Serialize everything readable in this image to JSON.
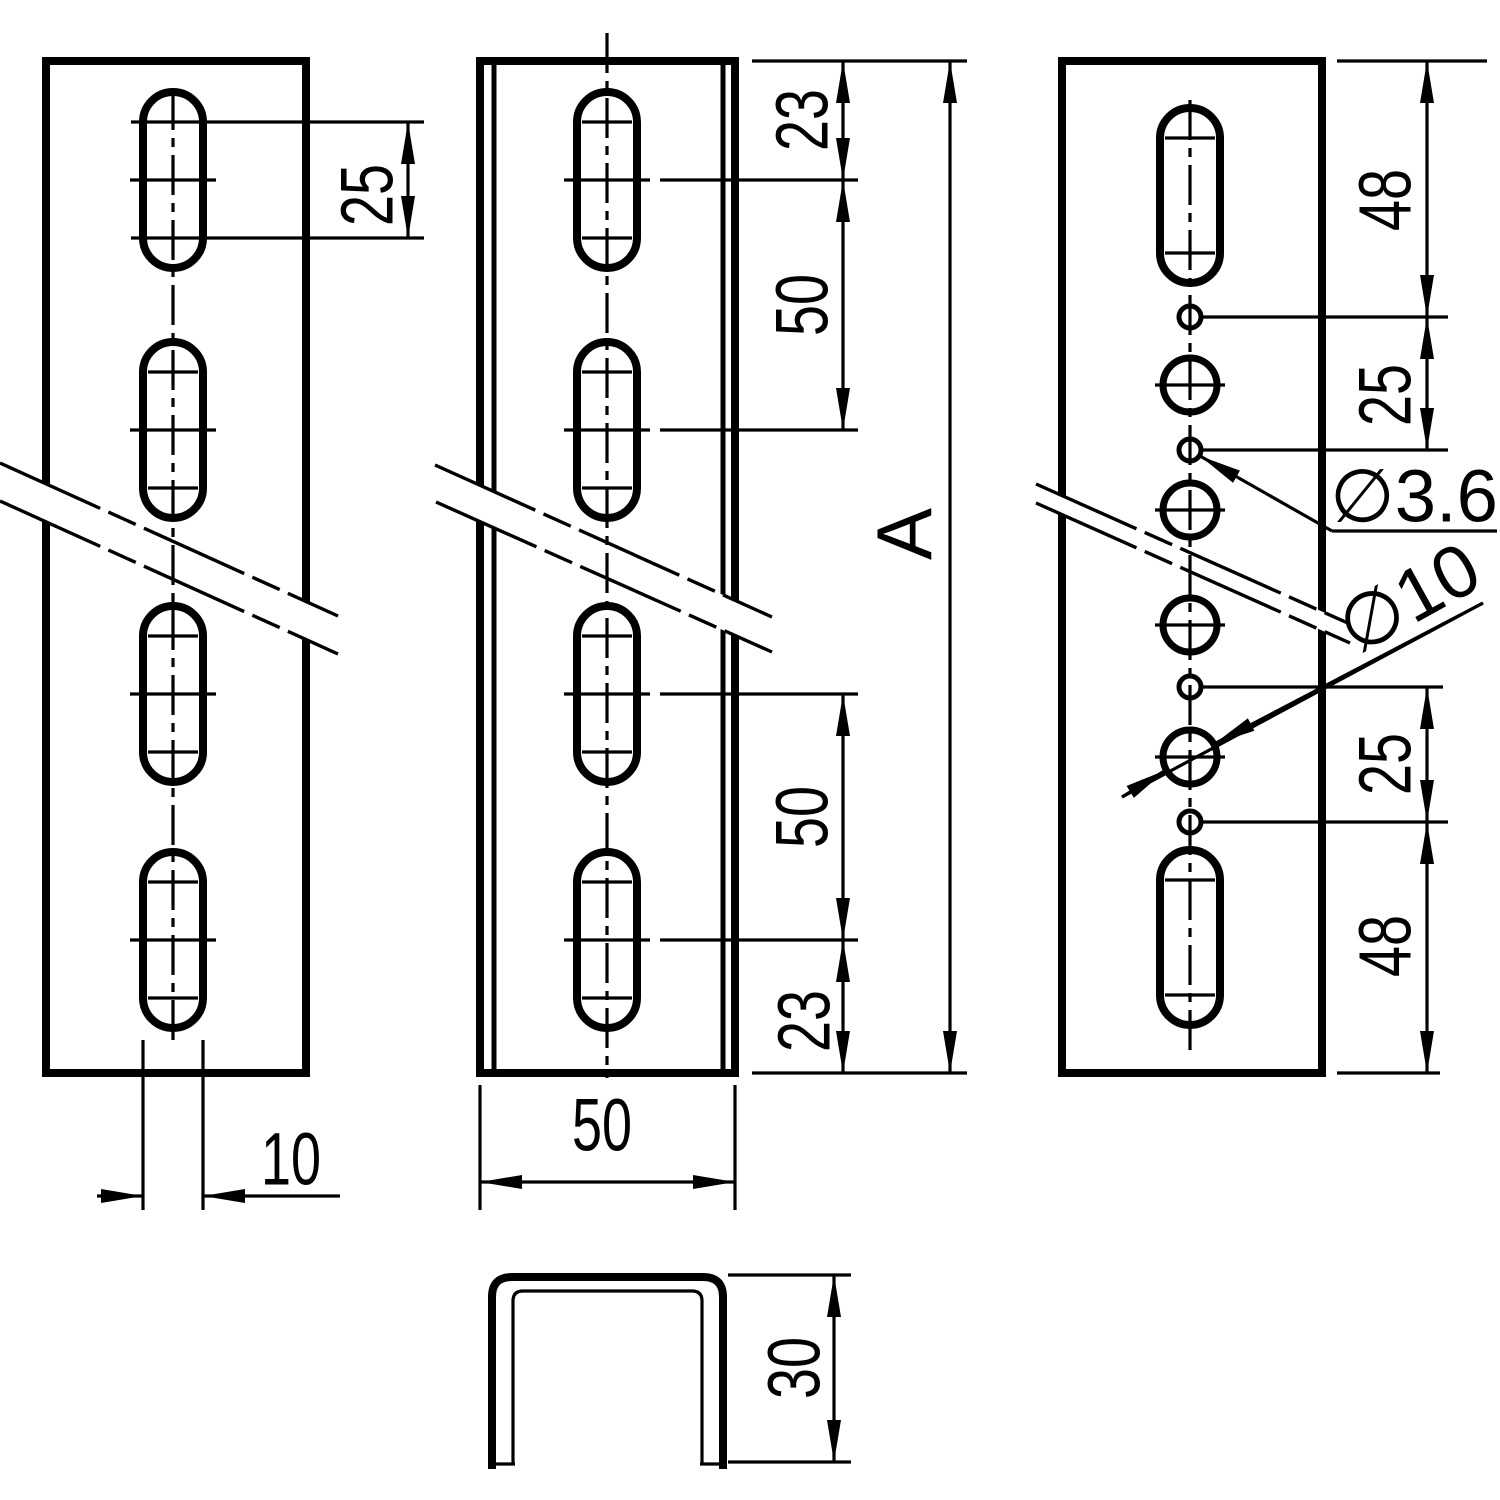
{
  "page": {
    "background": "#ffffff",
    "ink": "#000000",
    "title": "Perforated U-channel mounting rail - dimensioned engineering drawing"
  },
  "views": {
    "front_slotted": {
      "slot_length_label": "25",
      "slot_width_label": "10"
    },
    "channel_side": {
      "top_offset_label": "23",
      "upper_pitch_label": "50",
      "lower_pitch_label": "50",
      "bottom_offset_label": "23",
      "overall_length_label": "A",
      "width_label": "50"
    },
    "cross_section": {
      "height_label": "30"
    },
    "hole_pattern": {
      "top_end_distance_label": "48",
      "upper_pitch_label": "25",
      "small_hole_dia_label": "∅3.6",
      "large_hole_dia_label": "∅10",
      "lower_pitch_label": "25",
      "bottom_end_distance_label": "48"
    }
  }
}
